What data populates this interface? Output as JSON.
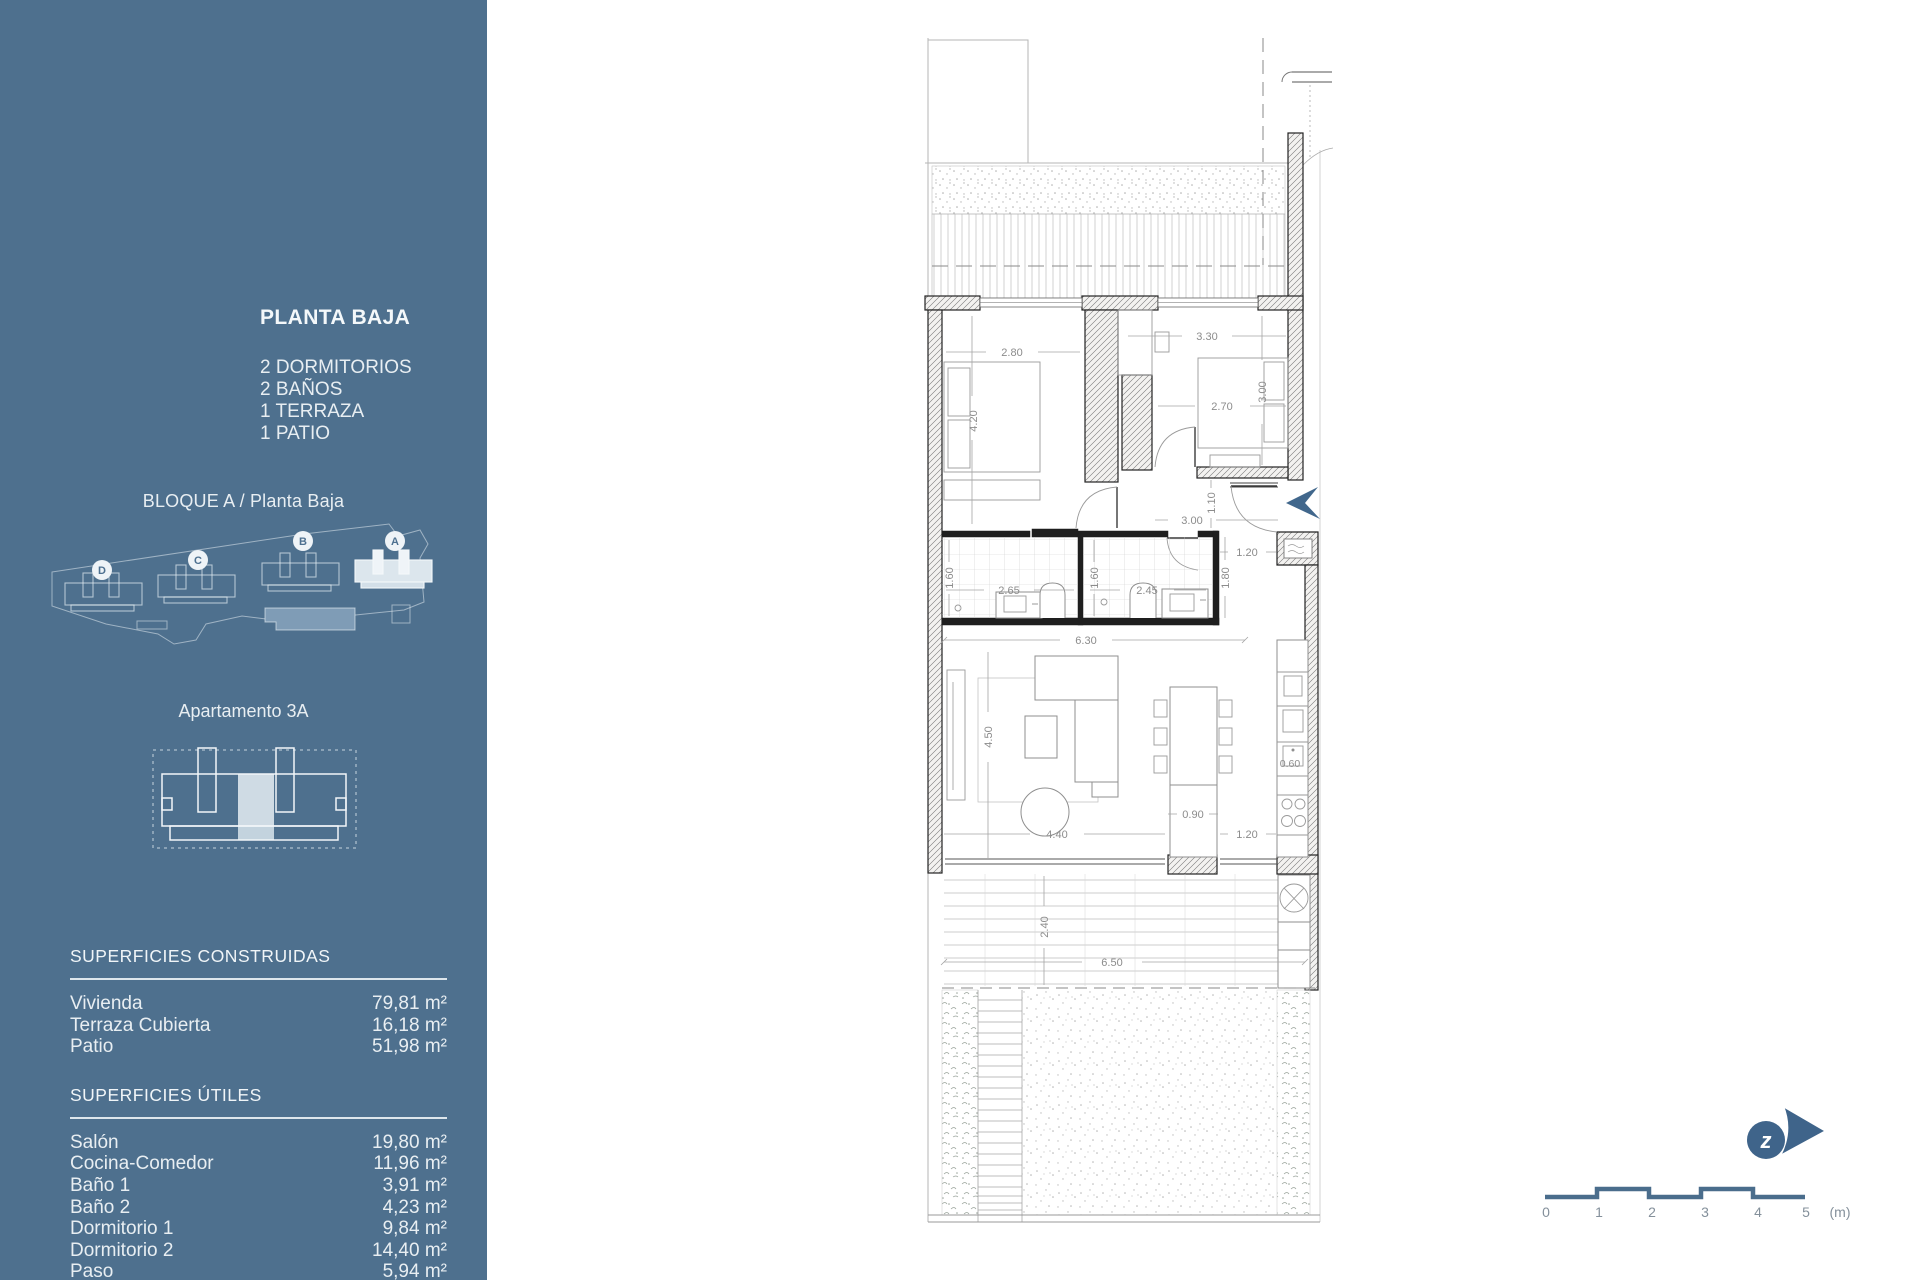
{
  "colors": {
    "sidebar_bg": "#4E708E",
    "accent": "#3F648A",
    "pool": "#7F9CB6",
    "highlight_unit": "#CFDBE4"
  },
  "sidebar": {
    "title": "PLANTA BAJA",
    "features": [
      "2 DORMITORIOS",
      "2 BAÑOS",
      "1 TERRAZA",
      "1 PATIO"
    ],
    "block_label": "BLOQUE A / Planta Baja",
    "site_blocks": {
      "d": "D",
      "c": "C",
      "b": "B",
      "a": "A"
    },
    "apartment_label": "Apartamento 3A",
    "superficies_construidas": {
      "heading": "SUPERFICIES CONSTRUIDAS",
      "rows": [
        {
          "label": "Vivienda",
          "value": "79,81 m²"
        },
        {
          "label": "Terraza Cubierta",
          "value": "16,18 m²"
        },
        {
          "label": "Patio",
          "value": "51,98 m²"
        }
      ]
    },
    "superficies_utiles": {
      "heading": "SUPERFICIES ÚTILES",
      "rows": [
        {
          "label": "Salón",
          "value": "19,80 m²"
        },
        {
          "label": "Cocina-Comedor",
          "value": "11,96 m²"
        },
        {
          "label": "Baño 1",
          "value": "3,91 m²"
        },
        {
          "label": "Baño 2",
          "value": "4,23 m²"
        },
        {
          "label": "Dormitorio 1",
          "value": "9,84 m²"
        },
        {
          "label": "Dormitorio 2",
          "value": "14,40 m²"
        },
        {
          "label": "Paso",
          "value": "5,94 m²"
        }
      ]
    }
  },
  "plan": {
    "dimensions": {
      "bedroom2_width": "2.80",
      "bedroom2_depth": "4.20",
      "bedroom1_top": "3.30",
      "bedroom1_width": "2.70",
      "bedroom1_depth": "3.00",
      "hall_depth": "1.10",
      "hall_width": "3.00",
      "bath1_depth": "1.60",
      "bath1_width": "2.65",
      "bath2_depth": "1.60",
      "bath2_width": "2.45",
      "entry_depth": "1.80",
      "entry_width": "1.20",
      "interior_width": "6.30",
      "living_depth": "4.50",
      "living_width": "4.40",
      "island_width": "0.90",
      "kitchen_width": "1.20",
      "kitchen_depth": "0.60",
      "terrace_depth": "2.40",
      "terrace_width": "6.50"
    }
  },
  "scale_bar": {
    "labels": [
      "0",
      "1",
      "2",
      "3",
      "4",
      "5"
    ],
    "unit": "(m)"
  }
}
